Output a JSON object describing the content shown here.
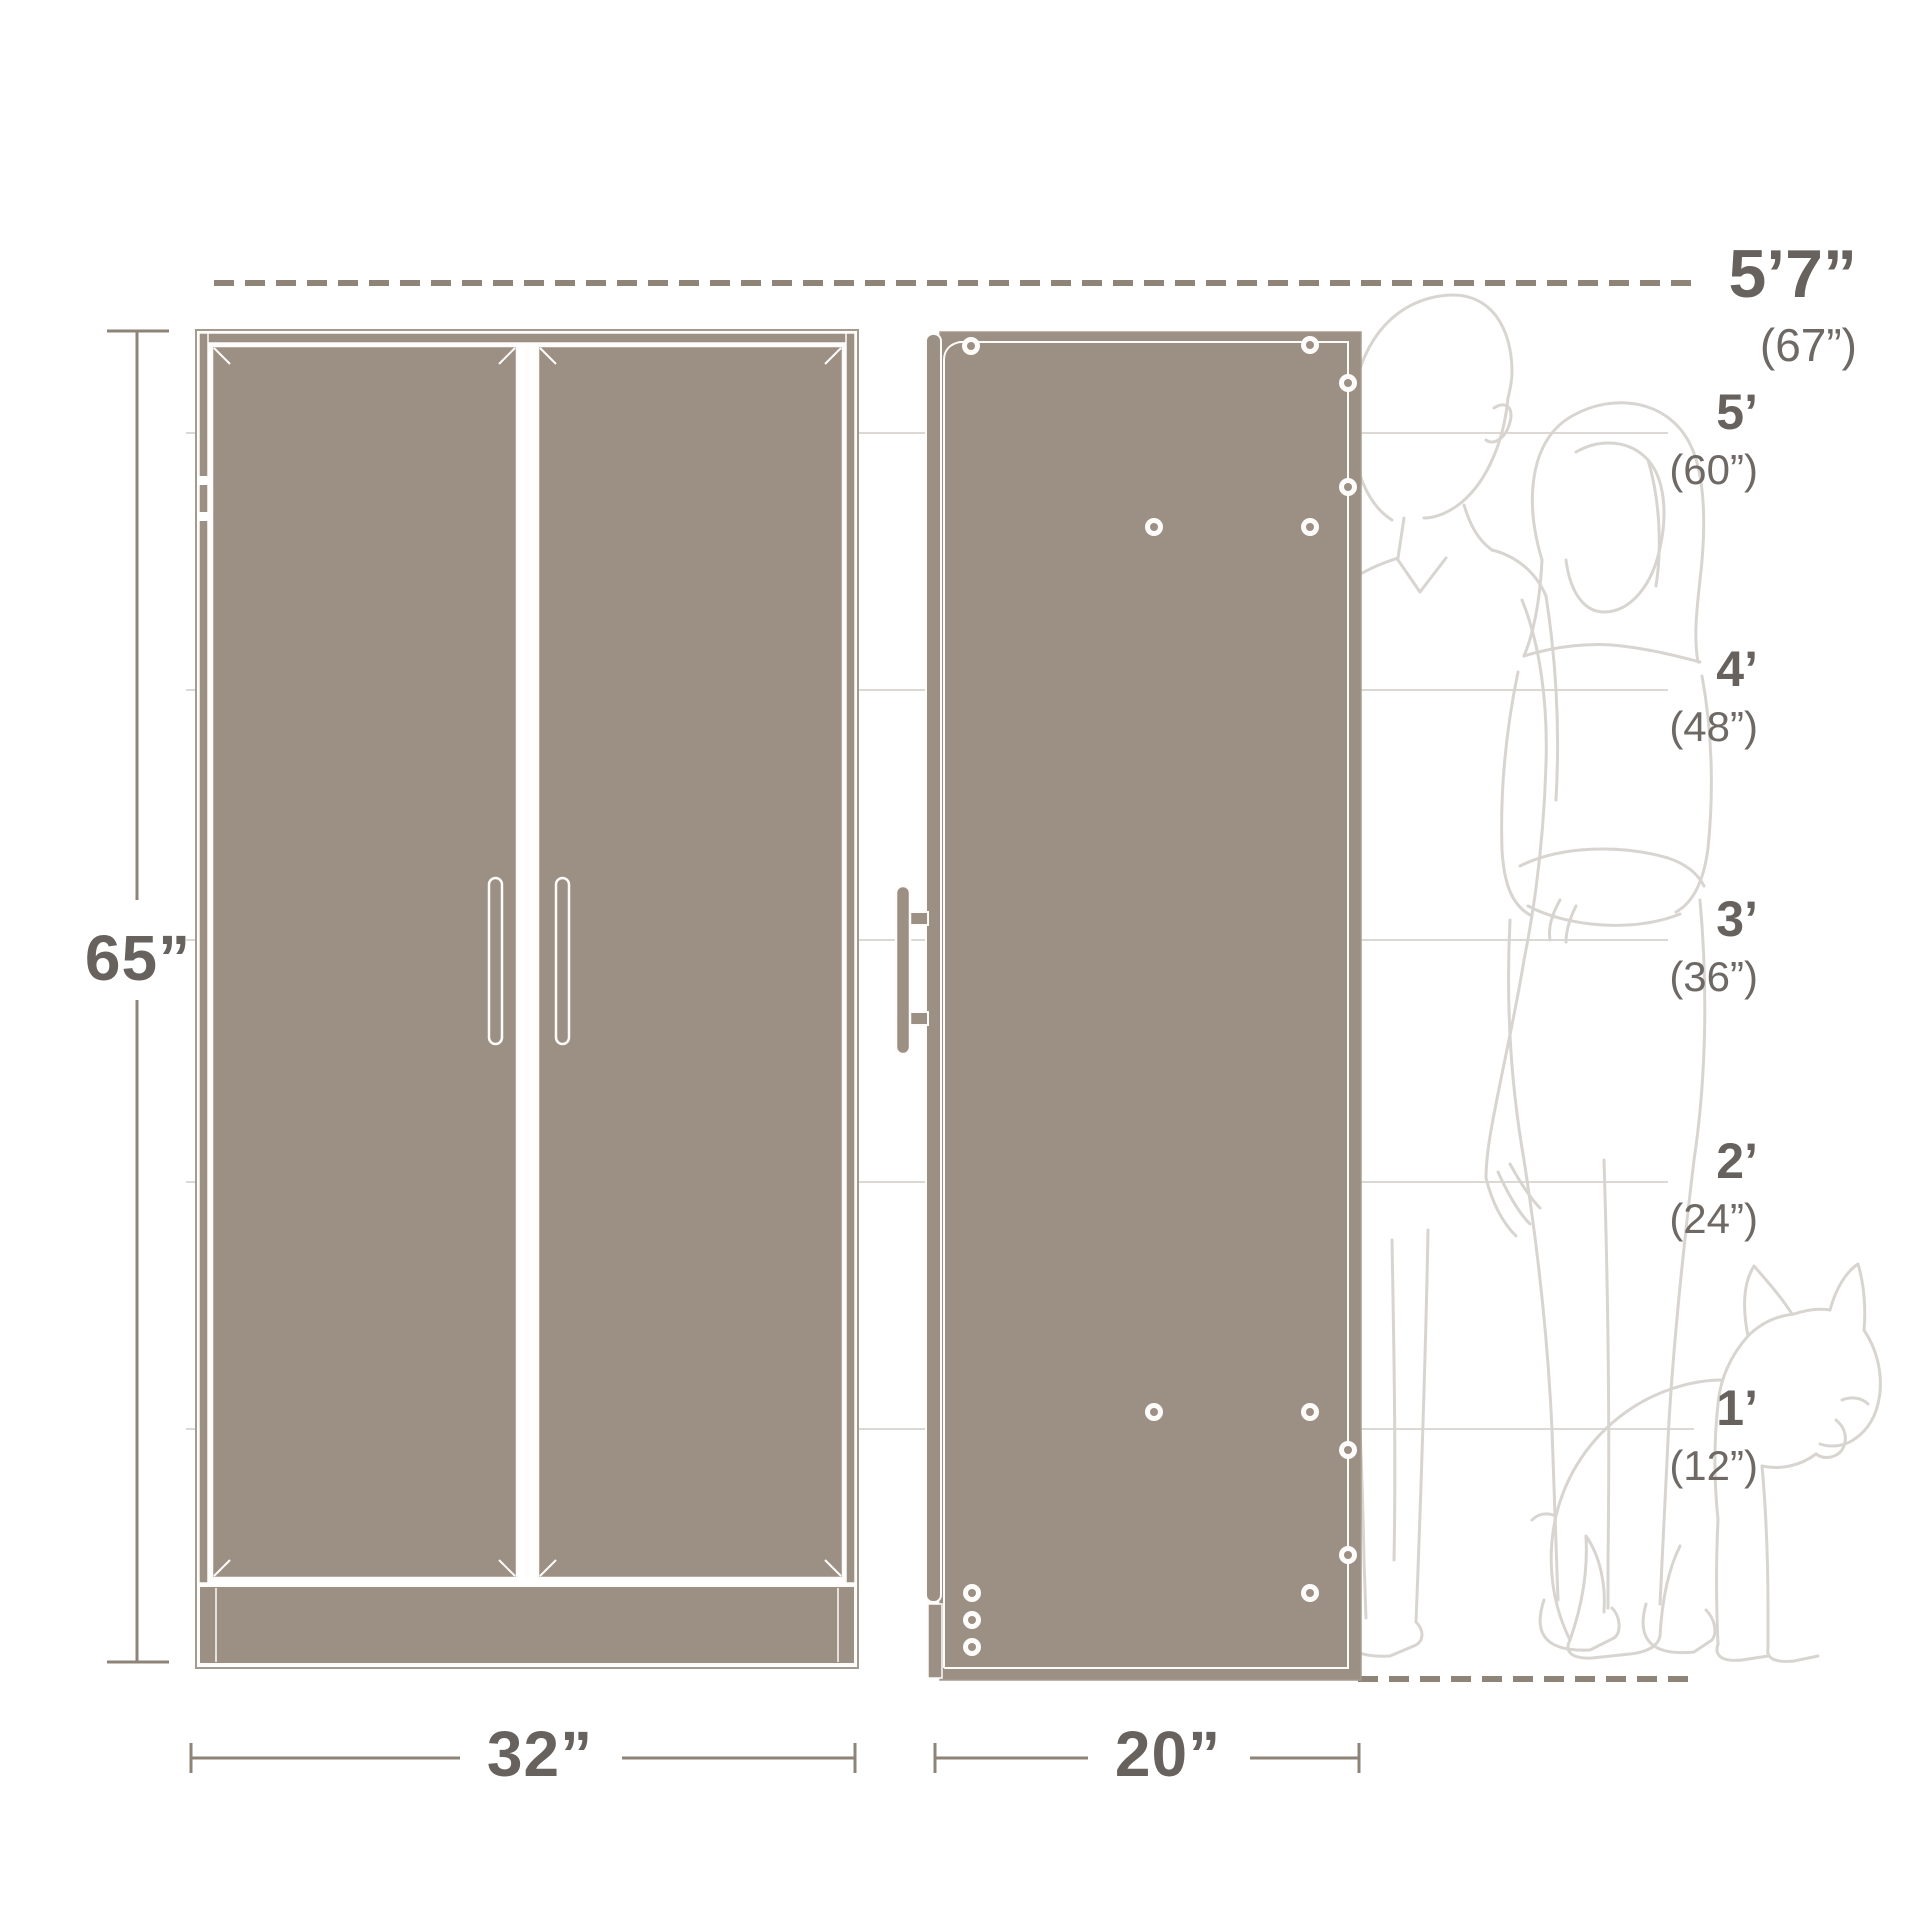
{
  "diagram": {
    "title_semantic": "cabinet-dimensions-diagram",
    "dimensions": {
      "height": "65”",
      "front_width": "32”",
      "side_depth": "20”"
    },
    "height_scale": {
      "max": {
        "feet": "5’7”",
        "inches": "(67”)"
      },
      "marks": [
        {
          "feet": "5’",
          "inches": "(60”)"
        },
        {
          "feet": "4’",
          "inches": "(48”)"
        },
        {
          "feet": "3’",
          "inches": "(36”)"
        },
        {
          "feet": "2’",
          "inches": "(24”)"
        },
        {
          "feet": "1’",
          "inches": "(12”)"
        }
      ]
    },
    "figures": {
      "left_person": "man-outline",
      "right_person": "woman-outline",
      "pet": "dog-outline"
    },
    "colors": {
      "cabinet_fill": "#9c8f83",
      "cabinet_outline": "#a59a8e",
      "panel_line_white": "#fdfcfa",
      "dashed_line": "#8f8478",
      "dimension_line": "#8d8377",
      "label_dark": "#67625d",
      "label_paren": "#6e6964",
      "figure_line": "#d8d5d1",
      "reference_line": "#dcd9d5",
      "background": "#ffffff"
    }
  }
}
